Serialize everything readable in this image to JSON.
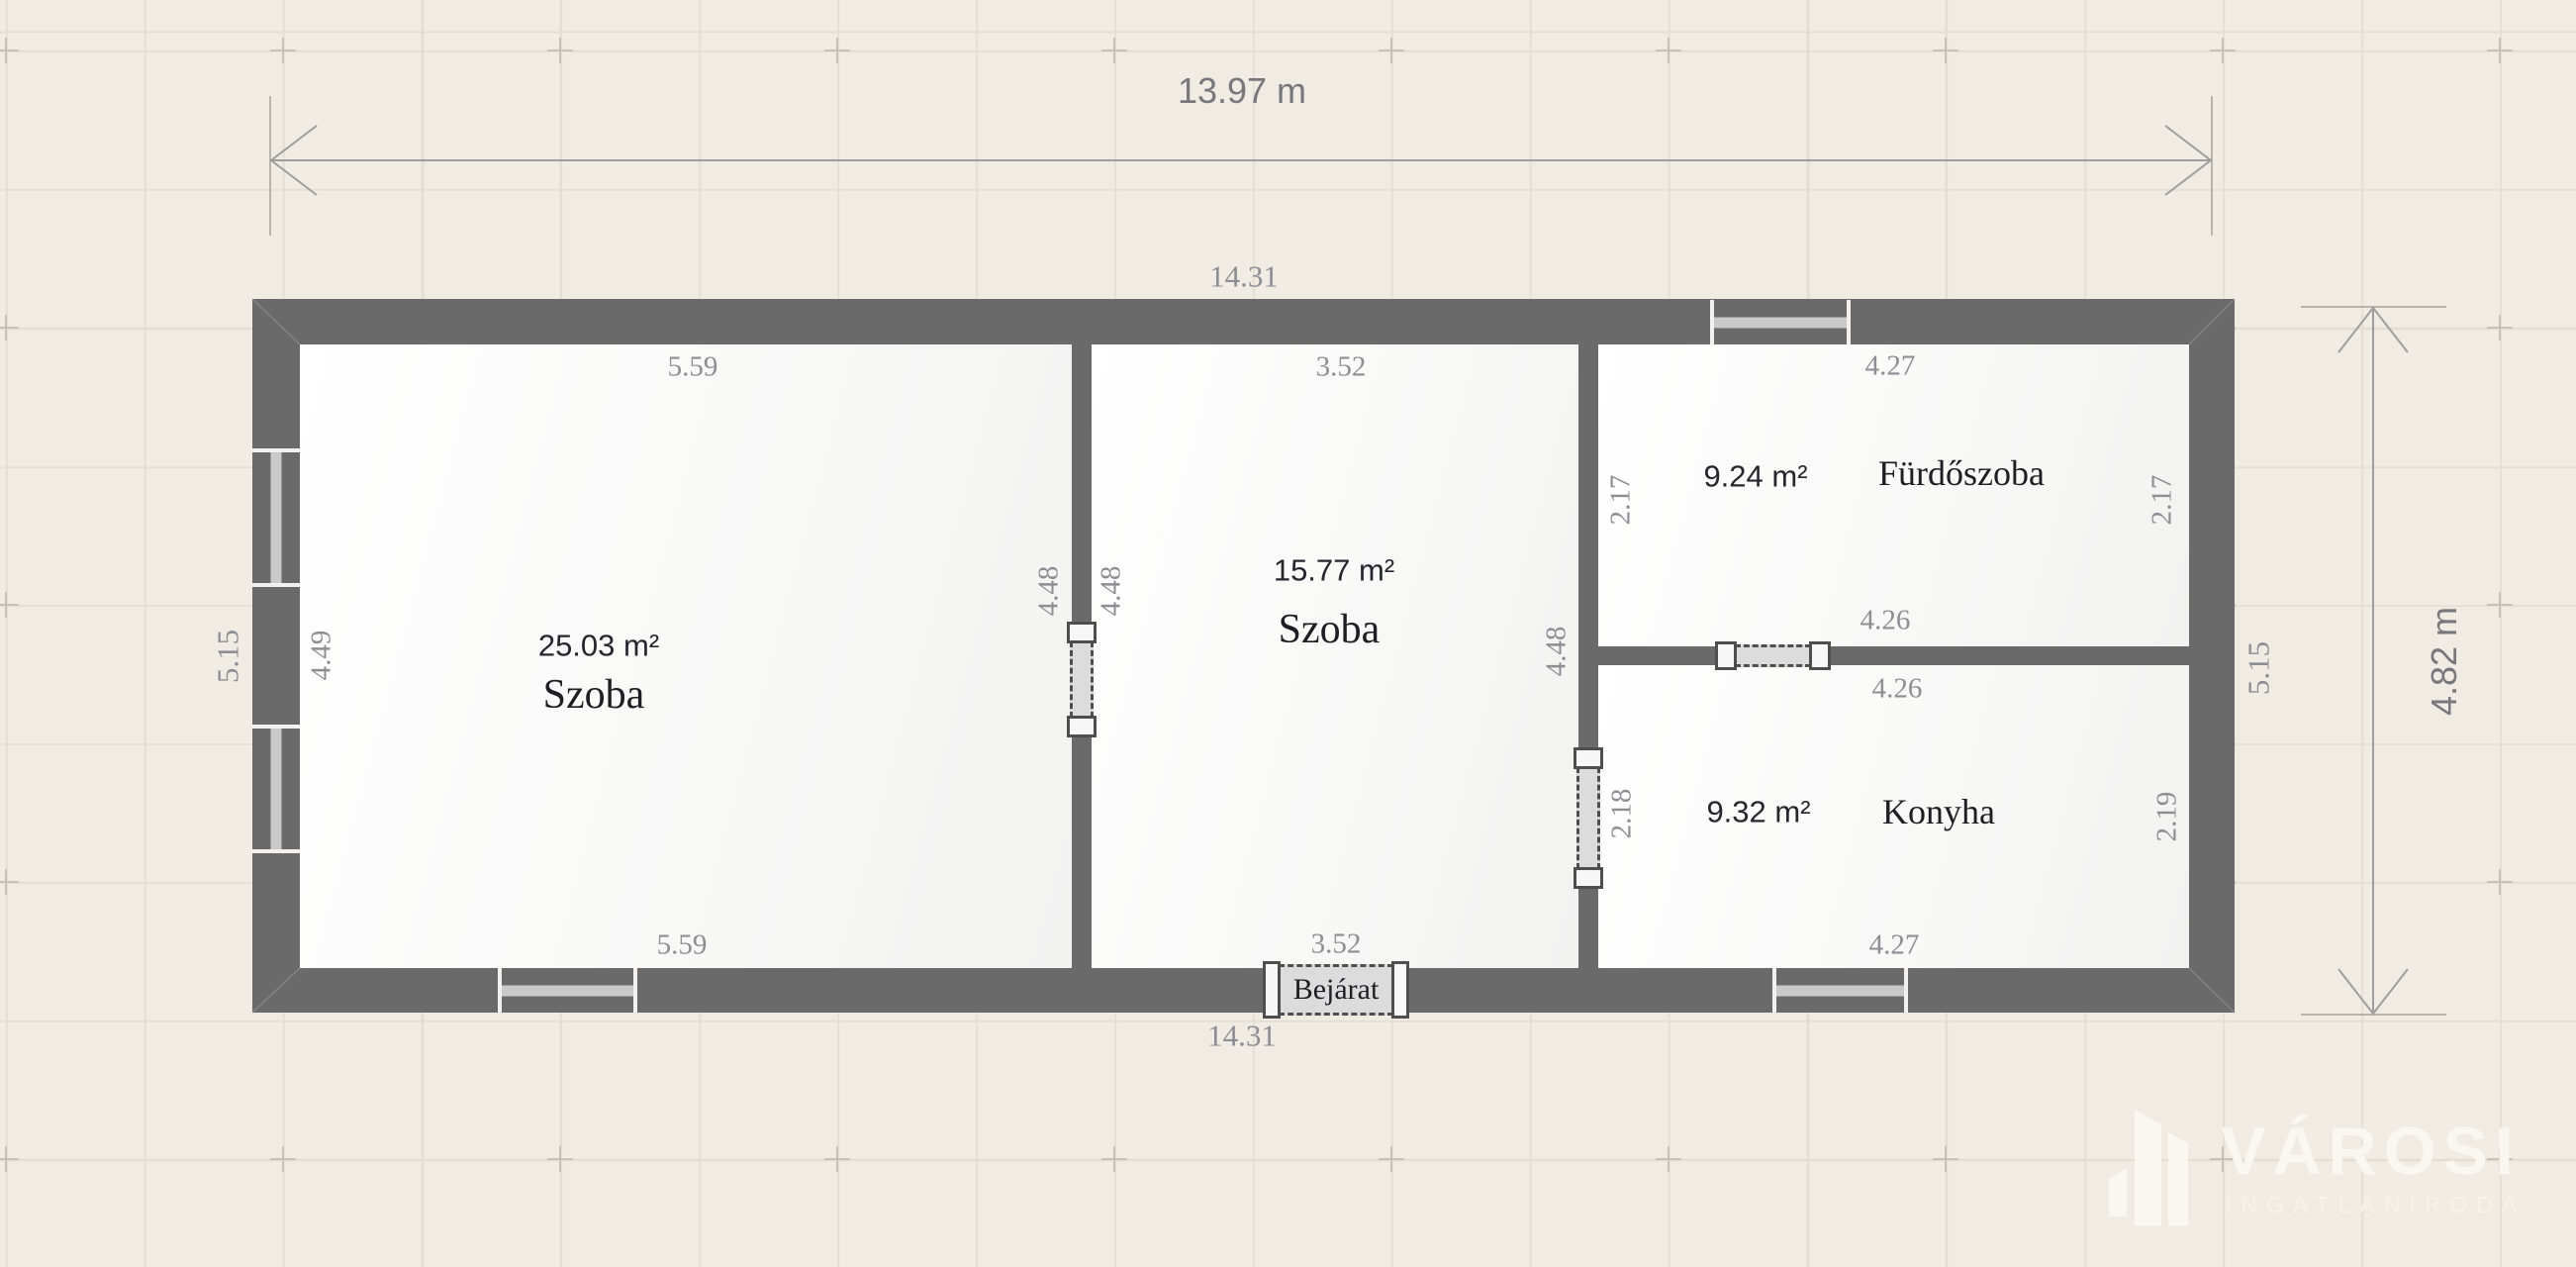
{
  "plan": {
    "total_width": "13.97 m",
    "total_height": "4.82 m",
    "outer": {
      "top": "14.31",
      "bottom": "14.31",
      "left": "5.15",
      "right": "5.15"
    },
    "rooms": [
      {
        "name": "Szoba",
        "area": "25.03 m²",
        "dims": {
          "top": "5.59",
          "bottom": "5.59",
          "left": "4.49",
          "right": "4.48"
        }
      },
      {
        "name": "Szoba",
        "area": "15.77 m²",
        "dims": {
          "top": "3.52",
          "bottom": "3.52",
          "left": "4.48",
          "right": "4.48"
        }
      },
      {
        "name": "Fürdőszoba",
        "area": "9.24 m²",
        "dims": {
          "top": "4.27",
          "bottom": "4.26",
          "left": "2.17",
          "right": "2.17"
        }
      },
      {
        "name": "Konyha",
        "area": "9.32 m²",
        "dims": {
          "top": "4.26",
          "bottom": "4.27",
          "left": "2.18",
          "right": "2.19"
        }
      }
    ],
    "entrance": "Bejárat"
  },
  "branding": {
    "logo_text": "VÁROSI",
    "logo_subtext": "INGATLANIRODA",
    "logo_icon": "city-buildings"
  },
  "colors": {
    "background": "#f0ece3",
    "grid": "#e3ded3",
    "wall": "#6a6a6a",
    "floor": "#fafafa",
    "dimension_text": "#8d8d94",
    "room_text": "#1e1e24",
    "big_dimension_text": "#77777c",
    "logo": "#faf7f0"
  }
}
